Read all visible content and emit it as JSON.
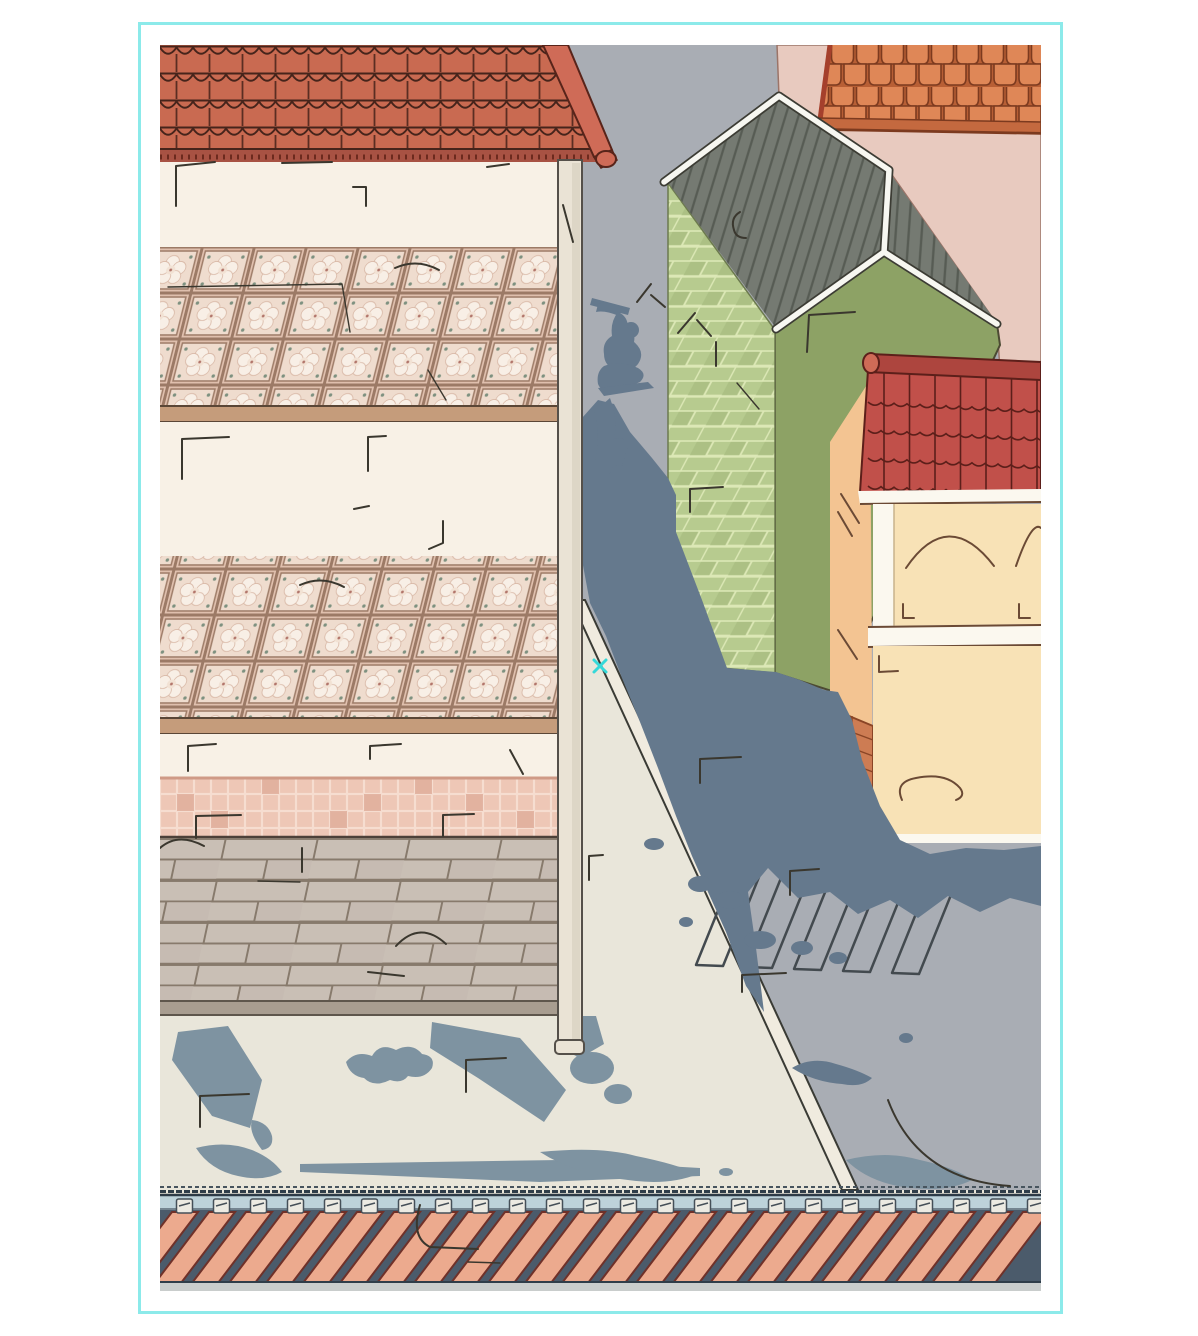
{
  "artwork": {
    "kind": "illustration",
    "description": "Aerial isometric comic-style illustration: a cutaway apartment building with red scalloped roof and patterned tile floors on the left, a gray street with a dramatic human shadow and crosswalk in the middle, a green brick house with dark standing-seam roof and a cream/peach house with red tile roof on the right, a pink-walled building with orange shingles top right, and a railway track strip along the bottom."
  },
  "frame": {
    "background": "#ffffff",
    "border_color": "#8ceaea"
  },
  "counts": {
    "railway_ties": 24,
    "crosswalk_stripes": 5,
    "left_building_levels": 3,
    "orange_roof_tile_rows": 4
  },
  "cursor": {
    "symbol": "x",
    "color": "#35d9d9"
  },
  "colors": {
    "street": "#a9adb4",
    "street_shadow": "#65798d",
    "plaza": "#e9e6da",
    "plaza_shadow": "#7e93a1",
    "curb_fill": "#f0ebdf",
    "curb_line": "#3a3b35",
    "crosswalk_line": "#434a4f",
    "roof_red": "#c96a51",
    "roof_red_line": "#46241b",
    "eave_band": "#a85243",
    "beam_top": "#cf6b57",
    "beam_side": "#a74c3e",
    "wall_cream": "#f8f1e6",
    "column": "#eae3d5",
    "column_line": "#55504a",
    "slab_band": "#c59c7b",
    "slab_line": "#5a4636",
    "floor_tile_bg": "#e1c1af",
    "floor_tile_grout": "#9c7a66",
    "floor_tile_inner": "#efdcce",
    "floor_tile_flower": "#f8efe6",
    "floor_tile_dot": "#7e9180",
    "wainscot": "#eec7b6",
    "wainscot_grout": "#f6ddd0",
    "wainscot_dark": "#dfae9b",
    "floor_brick": "#c9bfb5",
    "floor_brick_line": "#877a6c",
    "floor_edge": "#a89d90",
    "green_brick": "#b7cb8f",
    "green_brick_grout": "#dce8b6",
    "green_dark_face": "#8da265",
    "green_outline": "#4c4a33",
    "dark_roof": "#757a72",
    "dark_roof_seam": "#575c54",
    "trim_white": "#f7f7f1",
    "trim_outline": "#3c3c34",
    "pink_wall": "#e8cabf",
    "shingle": "#df8757",
    "shingle_bg": "#b85f35",
    "shingle_line": "#7c3a1f",
    "shingle_fascia": "#c4693f",
    "tile_roof_red": "#c1504a",
    "tile_roof_line": "#5c1f1a",
    "ridge_bar": "#ad453e",
    "peach_wall": "#f3c492",
    "front_cream": "#f8e2b6",
    "band_white": "#fbf8ef",
    "base_brick": "#cd7c53",
    "base_brick_line": "#8a4526",
    "detail_line": "#6b4a35",
    "rail_top_line": "#47545e",
    "rail": "#bdd2da",
    "ballast": "#4b5b6b",
    "railway_tie": "#ecaa8e",
    "railway_tie_outline": "#6f3129",
    "rail_bottom": "#c9cdcc",
    "clip_metal": "#eceae2",
    "mark": "#3a372e"
  }
}
